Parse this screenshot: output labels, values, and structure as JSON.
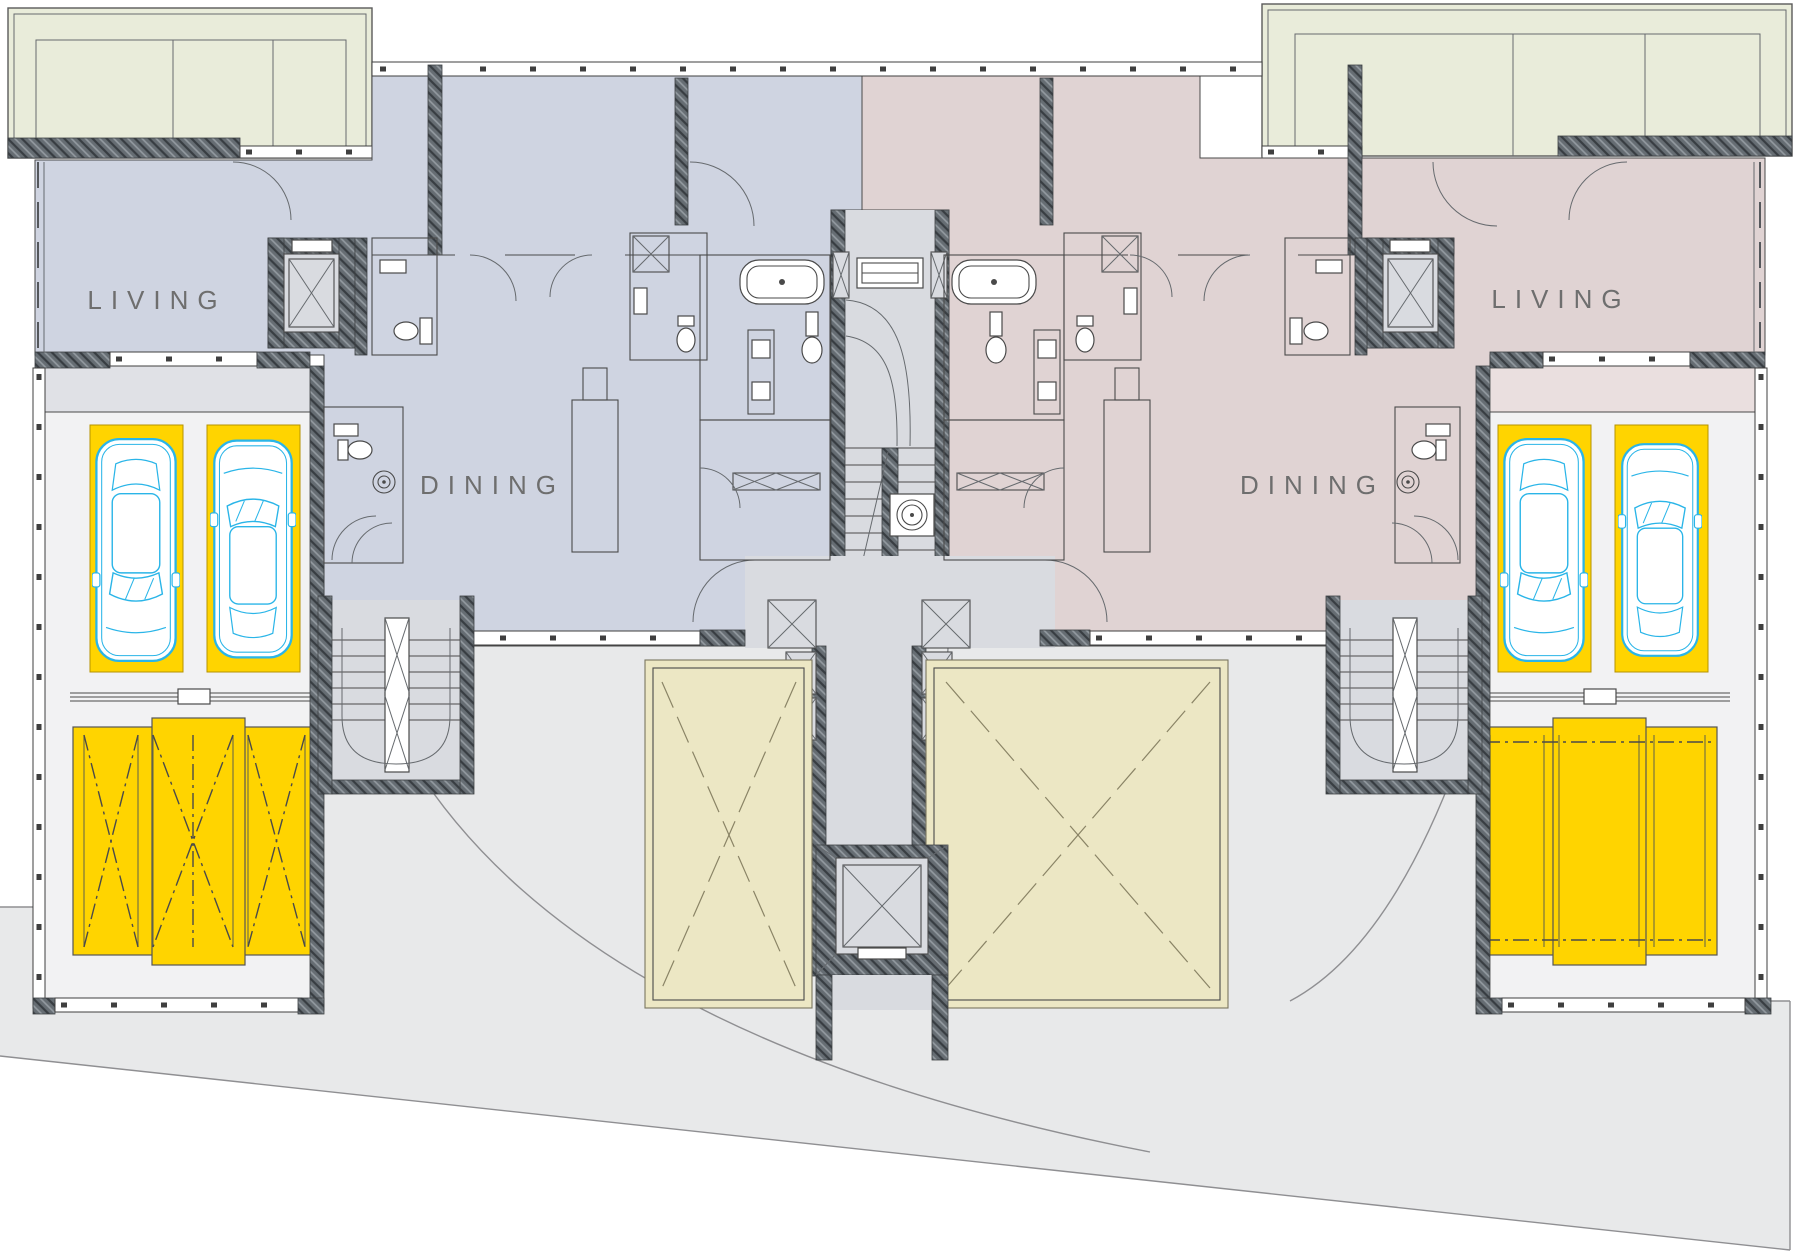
{
  "plan": {
    "type": "architectural-floor-plan",
    "labels": {
      "living_left": "LIVING",
      "dining_left": "DINING",
      "dining_right": "DINING",
      "living_right": "LIVING"
    },
    "colors": {
      "unit_left": "#cfd4e1",
      "unit_right": "#e0d3d3",
      "terrace": "#e9ecda",
      "storage": "#ece7c4",
      "parking": "#ffd400",
      "car": "#2ab5e8",
      "circulation": "#d9dbe0",
      "garage_floor": "#f2f2f3",
      "ground": "#e8e9ea",
      "wall": "#5a6066",
      "label": "#6e6e6e"
    },
    "features": {
      "units": 2,
      "cars_shown": 4,
      "parking_stalls": 4,
      "car_lift_platforms": 2,
      "elevators": 3,
      "stairways": 3,
      "storage_rooms": 2,
      "terraces": 2
    }
  }
}
